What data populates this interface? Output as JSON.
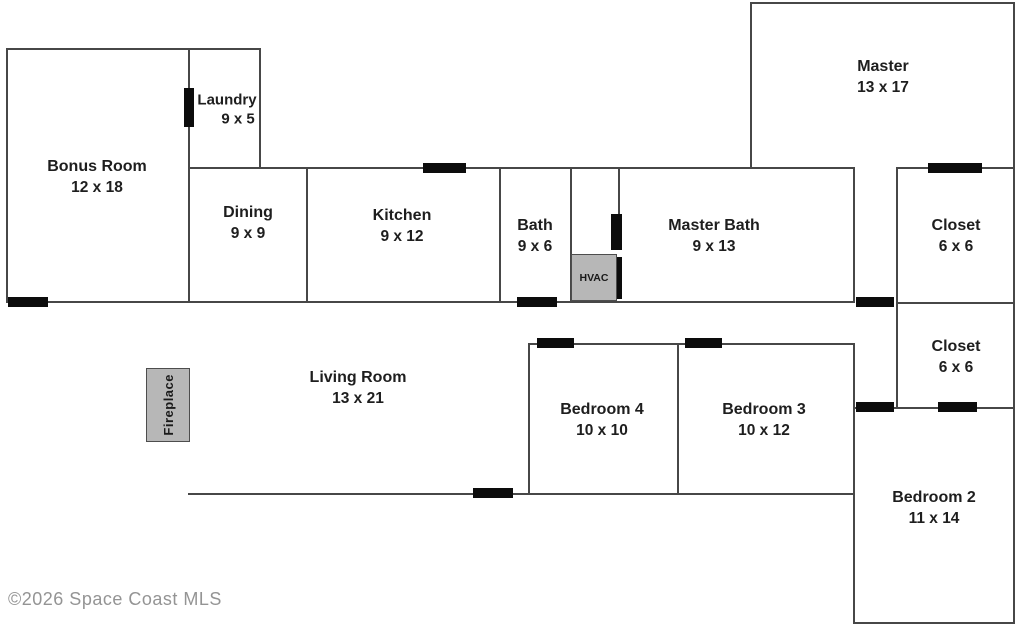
{
  "plan": {
    "rooms": {
      "bonus": {
        "name": "Bonus Room",
        "dims": "12 x 18"
      },
      "laundry": {
        "name": "Laundry",
        "dims": "9 x 5"
      },
      "dining": {
        "name": "Dining",
        "dims": "9 x 9"
      },
      "kitchen": {
        "name": "Kitchen",
        "dims": "9 x 12"
      },
      "bath": {
        "name": "Bath",
        "dims": "9 x 6"
      },
      "master_bath": {
        "name": "Master Bath",
        "dims": "9 x 13"
      },
      "master": {
        "name": "Master",
        "dims": "13 x 17"
      },
      "closet1": {
        "name": "Closet",
        "dims": "6 x 6"
      },
      "closet2": {
        "name": "Closet",
        "dims": "6 x 6"
      },
      "living": {
        "name": "Living Room",
        "dims": "13 x 21"
      },
      "bedroom4": {
        "name": "Bedroom 4",
        "dims": "10 x 10"
      },
      "bedroom3": {
        "name": "Bedroom 3",
        "dims": "10 x 12"
      },
      "bedroom2": {
        "name": "Bedroom 2",
        "dims": "11 x 14"
      }
    },
    "fixtures": {
      "hvac": "HVAC",
      "fireplace": "Fireplace"
    },
    "copyright": "©2026 Space Coast MLS",
    "colors": {
      "wall": "#474747",
      "door": "#0c0c0c",
      "fixture": "#b7b7b7",
      "label": "#1e1e1e",
      "copyright": "#949494",
      "bg": "#ffffff"
    }
  }
}
